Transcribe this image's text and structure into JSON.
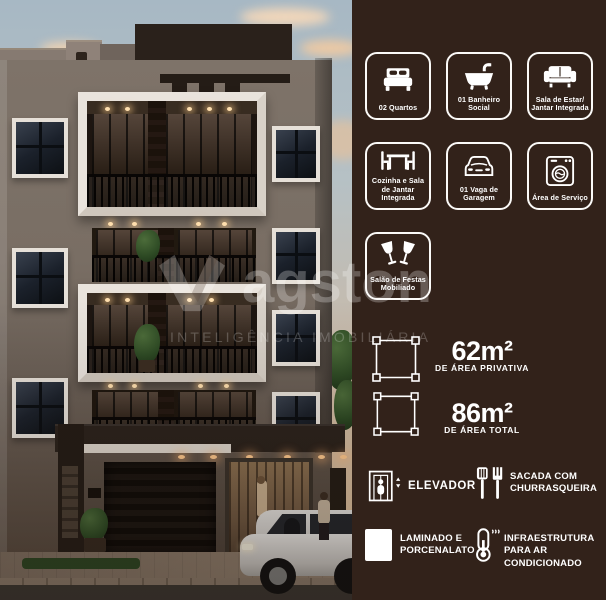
{
  "watermark": {
    "brand_text": "agston",
    "tagline": "INTELIGÊNCIA IMOBILIÁRIA",
    "logo_icon": "brand-logo-v-mark-icon"
  },
  "cards": [
    {
      "icon": "bed-icon",
      "label": "02 Quartos"
    },
    {
      "icon": "bathtub-icon",
      "label": "01 Banheiro Social"
    },
    {
      "icon": "sofa-icon",
      "label": "Sala de Estar/ Jantar Integrada"
    },
    {
      "icon": "dining-table-icon",
      "label": "Cozinha e Sala de Jantar Integrada"
    },
    {
      "icon": "car-icon",
      "label": "01 Vaga de Garagem"
    },
    {
      "icon": "washing-machine-icon",
      "label": "Área de Serviço"
    },
    {
      "icon": "cheers-glasses-icon",
      "label": "Salão de Festas Mobiliado"
    }
  ],
  "areas": [
    {
      "icon": "area-dimensions-icon",
      "value": "62m²",
      "caption": "DE ÁREA PRIVATIVA"
    },
    {
      "icon": "area-dimensions-icon",
      "value": "86m²",
      "caption": "DE ÁREA TOTAL"
    }
  ],
  "amenities": [
    {
      "icon": "elevator-icon",
      "label": "ELEVADOR"
    },
    {
      "icon": "barbecue-tools-icon",
      "label": "SACADA COM CHURRASQUEIRA"
    },
    {
      "icon": "floor-tile-icon",
      "label": "LAMINADO E PORCENALATO"
    },
    {
      "icon": "thermometer-icon",
      "label": "INFRAESTRUTURA PARA AR CONDICIONADO"
    }
  ],
  "colors": {
    "panel_background": "#32221A",
    "accent_white": "#FFFFFF",
    "sky_top": "#A7B8C4",
    "cloud_peach": "#ECCDA9",
    "facade_taupe": "#7D7269",
    "roof_dark": "#2A211B",
    "grass_green": "#2C4522"
  }
}
